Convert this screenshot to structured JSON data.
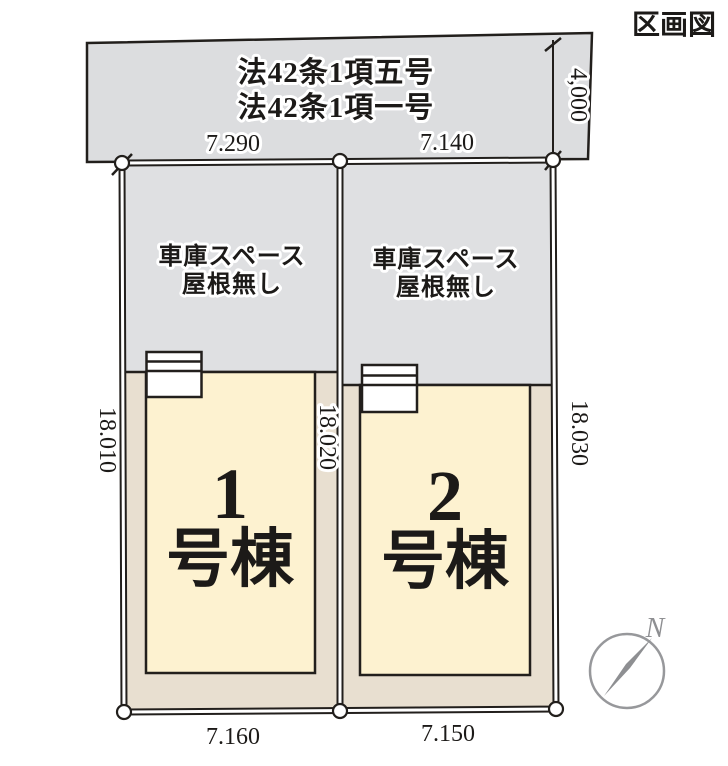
{
  "title": "区画図",
  "road": {
    "law_line1": "法42条1項五号",
    "law_line2": "法42条1項一号",
    "width_dim": "4,000"
  },
  "dims": {
    "lot1_top": "7.290",
    "lot2_top": "7.140",
    "lot1_bottom": "7.160",
    "lot2_bottom": "7.150",
    "left_side": "18.010",
    "middle": "18.020",
    "right_side": "18.030"
  },
  "lot1": {
    "garage_line1": "車庫スペース",
    "garage_line2": "屋根無し",
    "number": "1",
    "suffix": "号棟"
  },
  "lot2": {
    "garage_line1": "車庫スペース",
    "garage_line2": "屋根無し",
    "number": "2",
    "suffix": "号棟"
  },
  "compass": {
    "north": "N"
  },
  "colors": {
    "road": "#dcdddf",
    "garage": "#dfe0e2",
    "ground": "#e8dfd0",
    "building": "#fdf2d0",
    "line": "#221f1c",
    "compass": "#97989b",
    "needle": "#8e8f92"
  }
}
